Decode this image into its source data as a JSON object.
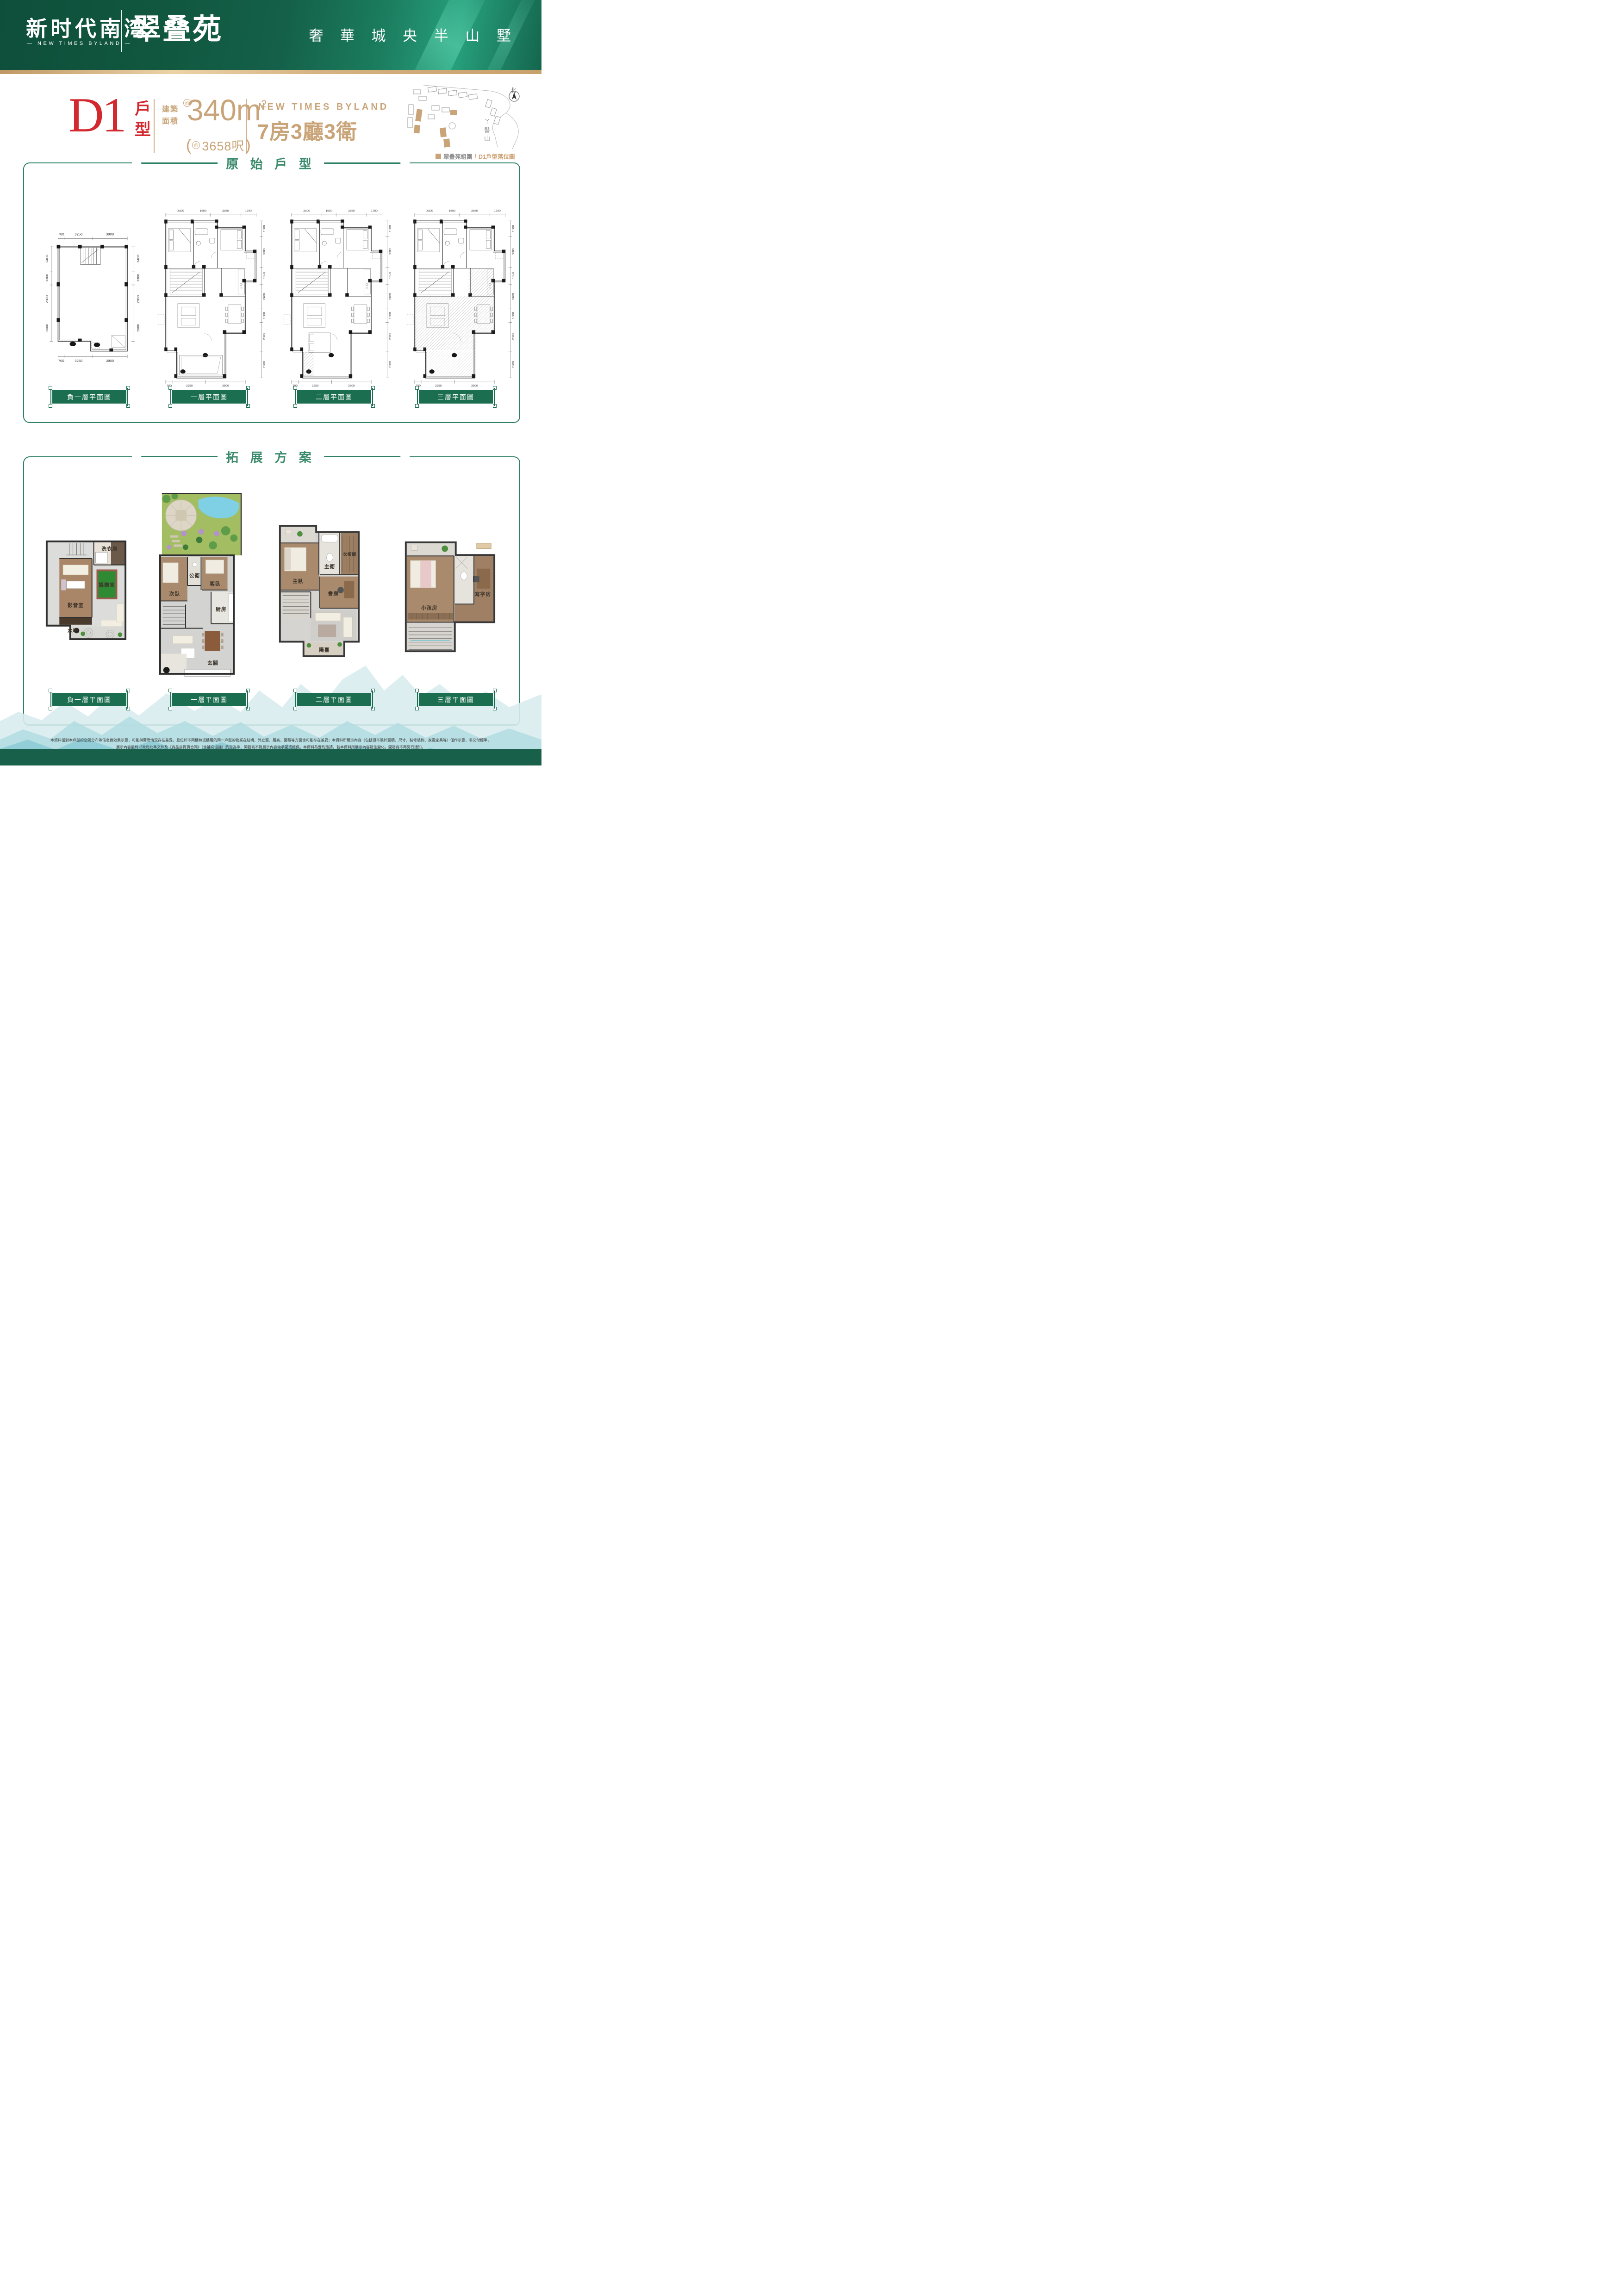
{
  "header": {
    "logo_cn": "新时代南湾",
    "logo_en": "— NEW TIMES BYLAND —",
    "project_name": "翠叠苑",
    "tagline": "奢 華 城 央 半 山 墅"
  },
  "unit_info": {
    "unit_code": "D1",
    "unit_type_label": "戶型",
    "area_label_line1": "建築",
    "area_label_line2": "面積",
    "approx_badge": "約",
    "area_value": "340m",
    "area_sup": "2",
    "area_ft_open": "(",
    "area_ft_approx": "約",
    "area_ft_value": "3658呎",
    "area_ft_close": ")",
    "brand_en": "NEW TIMES BYLAND",
    "layout_spec": "7房3廳3衛"
  },
  "site_map": {
    "north_label": "北",
    "mountain_label": "丫髻山",
    "legend_name": "翠叠苑組團",
    "legend_sep": "/",
    "legend_desc": "D1戶型落位圖"
  },
  "sections": {
    "original_title": "原 始 戶 型",
    "expanded_title": "拓 展 方 案"
  },
  "plan_labels": [
    "負一層平面圖",
    "一層平面圖",
    "二層平面圖",
    "三層平面圖"
  ],
  "dims_basement": {
    "top": [
      "700",
      "3250",
      "3900"
    ],
    "side": [
      "2400",
      "1300",
      "2800",
      "2600"
    ],
    "bottom": [
      "700",
      "3250",
      "3900"
    ]
  },
  "dims_tall": {
    "top": [
      "3400",
      "1600",
      "3450",
      "1700"
    ],
    "side": [
      "1500",
      "3000",
      "1650",
      "2400",
      "1300",
      "2800",
      "2600"
    ],
    "bottom": [
      "700",
      "3250",
      "3900"
    ]
  },
  "expanded_rooms": {
    "b1": [
      "洗衣房",
      "影音室",
      "娛樂室",
      "水吧"
    ],
    "f1": [
      "次臥",
      "公衛",
      "客臥",
      "厨房",
      "玄關"
    ],
    "f2": [
      "主臥",
      "主衛",
      "衣帽間",
      "書房",
      "陽臺"
    ],
    "f3": [
      "小孩房",
      "寫字房"
    ]
  },
  "footer": {
    "line1": "本資料僅對本戶型的空間分布等信息做效果示意，可能與實際情況存在差異，且位於不同樓棟或樓層的同一戶型的物業在結構、外立面、層高、面積等方面也可能存在差異；本資料所展示內容（包括但不限於面積、尺寸、裝修裝飾、家電家具等）僅作示意，非交付標準，",
    "line2": "展示內容最終以政府批準文件及《商品房買賣合同》（含補充協議）約定為準，開發商不對展示內容做承諾或擔保。本資料為要約邀請，若本資料所展示內容發生變化，開發商不再另行通知。"
  }
}
